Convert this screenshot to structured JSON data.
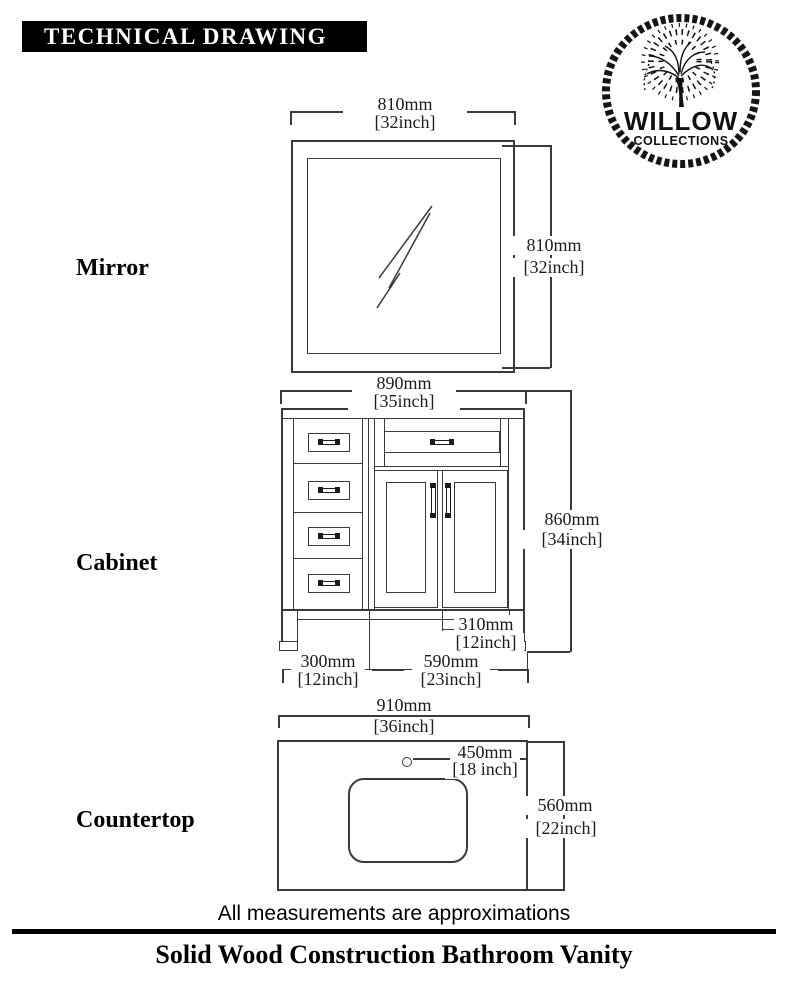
{
  "header": {
    "title": "TECHNICAL DRAWING"
  },
  "logo": {
    "brand": "WILLOW",
    "subbrand": "COLLECTIONS"
  },
  "sections": {
    "mirror": {
      "label": "Mirror",
      "width_mm": "810mm",
      "width_in": "[32inch]",
      "height_mm": "810mm",
      "height_in": "[32inch]"
    },
    "cabinet": {
      "label": "Cabinet",
      "width_mm": "890mm",
      "width_in": "[35inch]",
      "height_mm": "860mm",
      "height_in": "[34inch]",
      "depth_mm": "310mm",
      "depth_in": "[12inch]",
      "drawer_mm": "300mm",
      "drawer_in": "[12inch]",
      "door_mm": "590mm",
      "door_in": "[23inch]"
    },
    "countertop": {
      "label": "Countertop",
      "width_mm": "910mm",
      "width_in": "[36inch]",
      "faucet_mm": "450mm",
      "faucet_in": "[18 inch]",
      "depth_mm": "560mm",
      "depth_in": "[22inch]"
    }
  },
  "footer": {
    "note": "All measurements are approximations",
    "title": "Solid Wood Construction Bathroom Vanity"
  },
  "colors": {
    "line": "#3a3a3a",
    "text": "#1a1a1a",
    "accent": "#000000"
  }
}
